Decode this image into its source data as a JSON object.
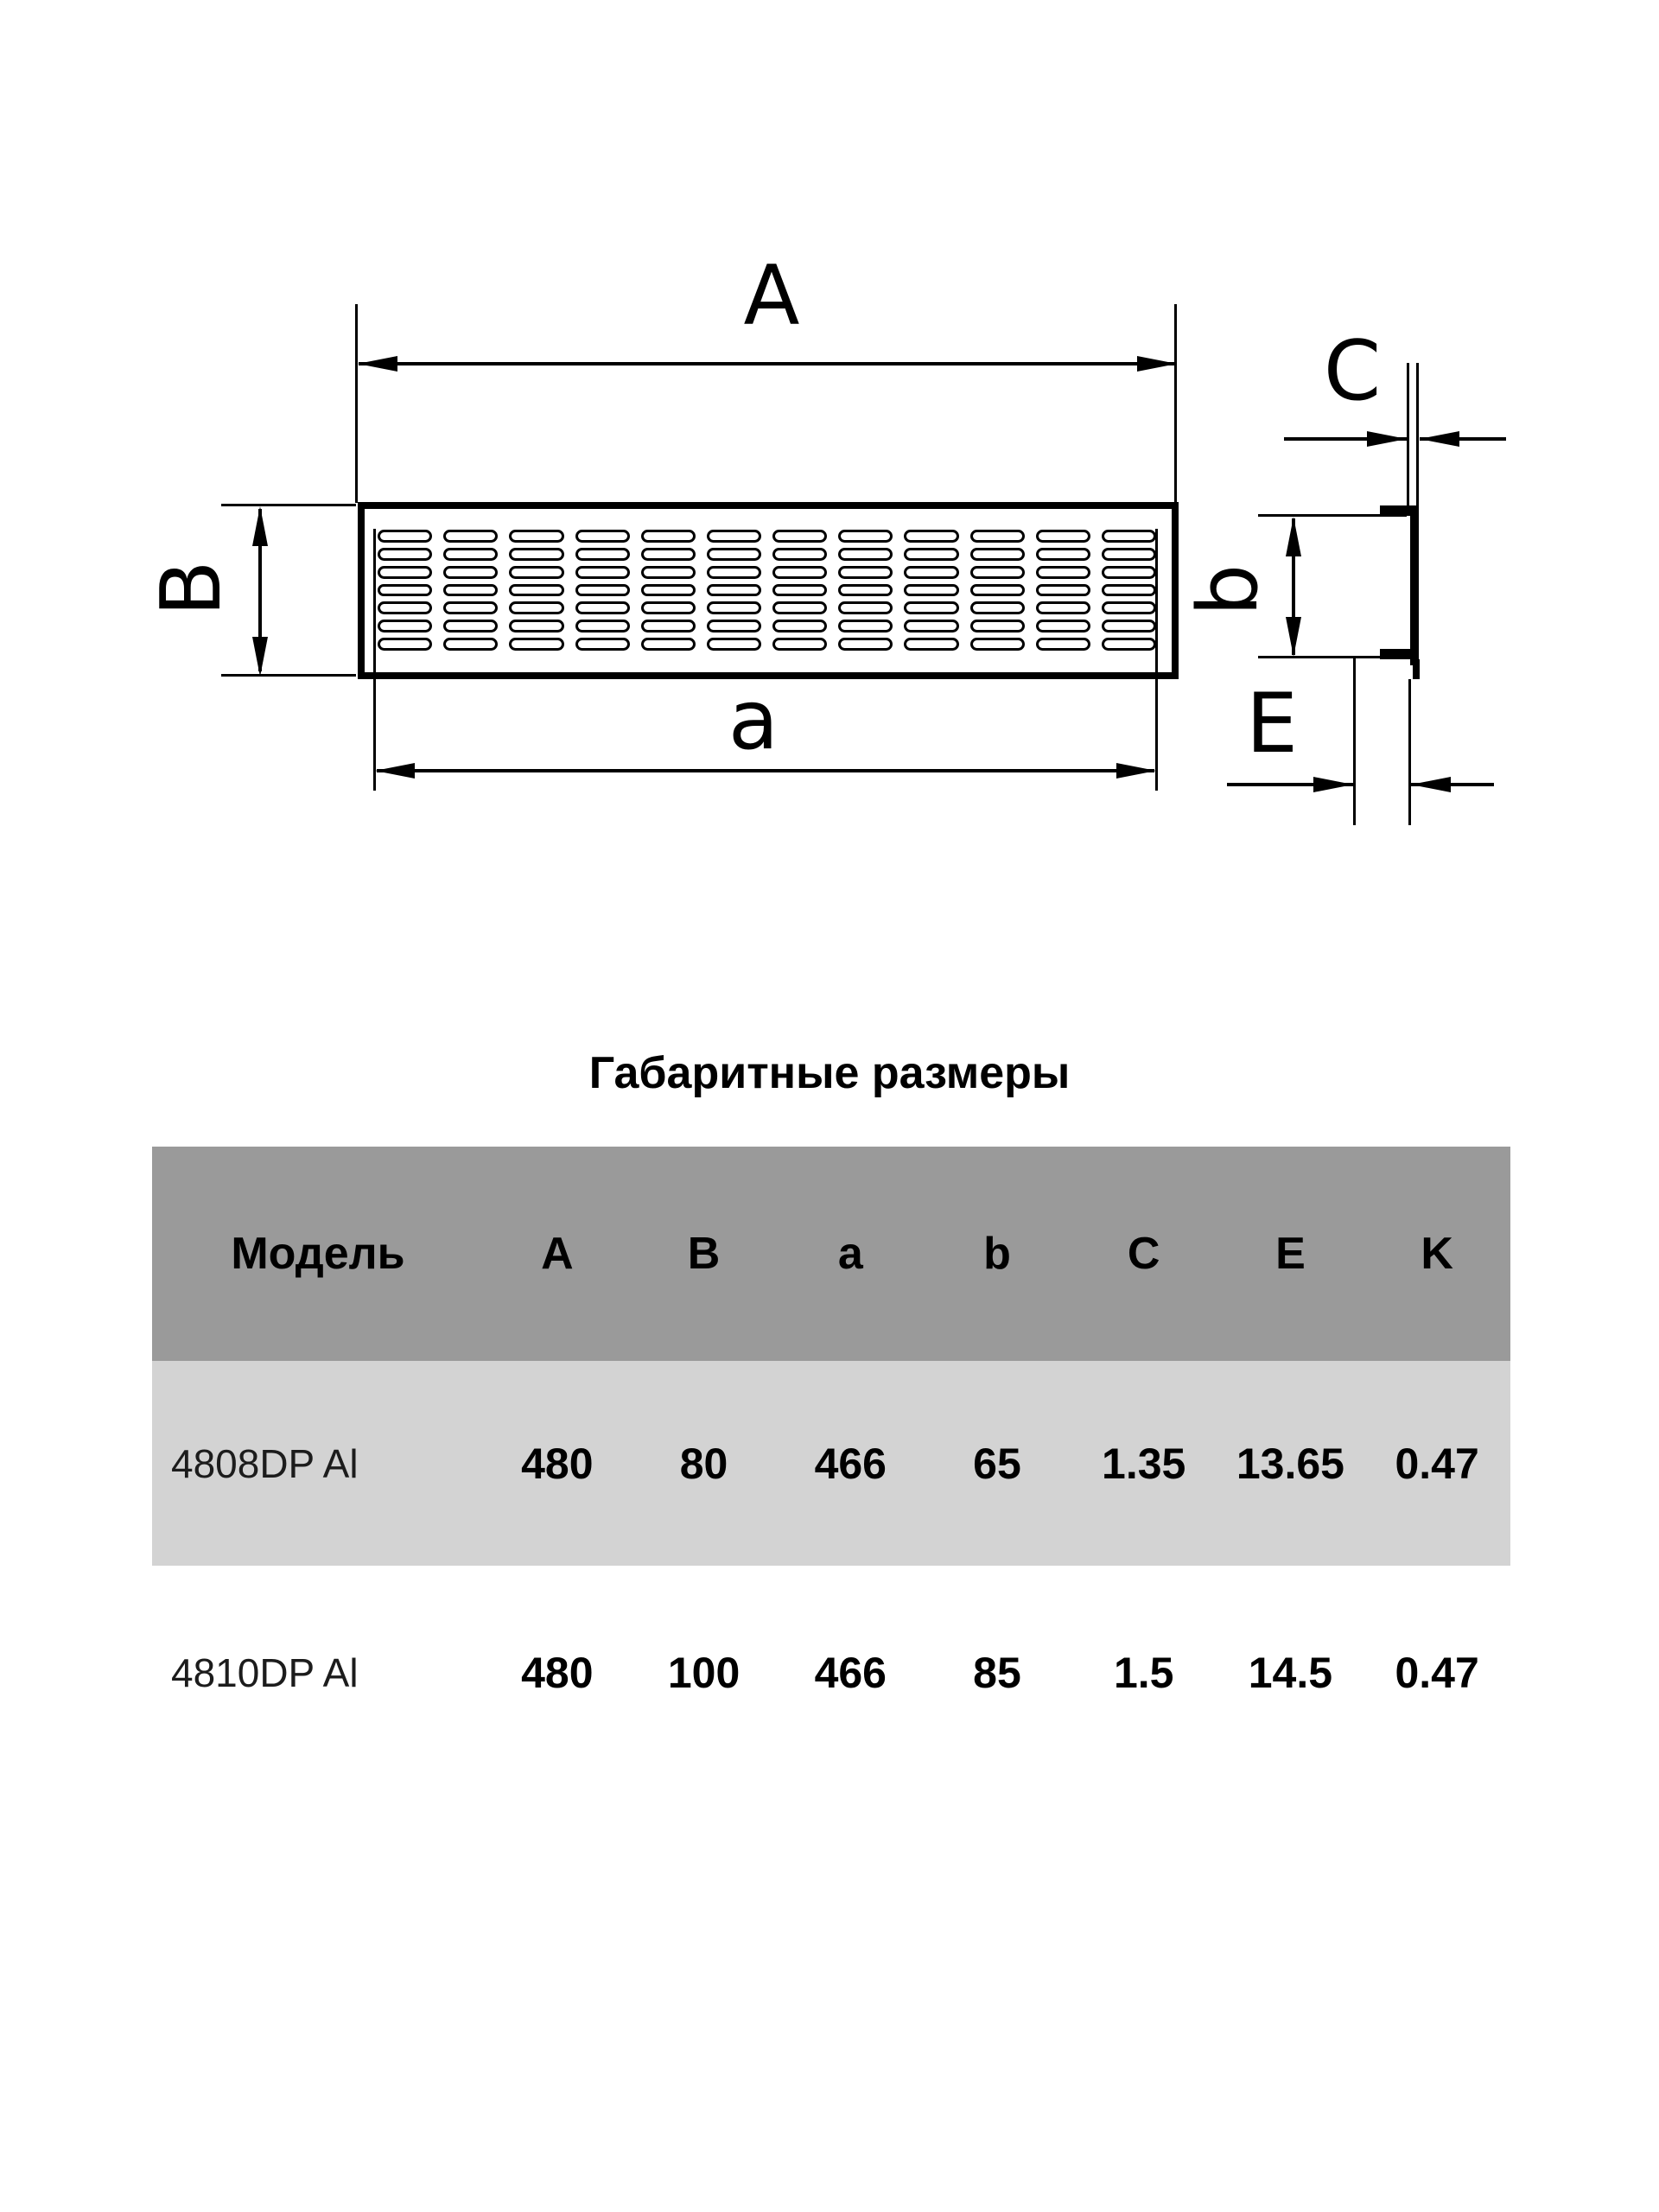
{
  "page": {
    "background": "#ffffff",
    "line_color": "#000000"
  },
  "drawing": {
    "front_view": {
      "label_A": "A",
      "label_B": "B",
      "label_a": "a",
      "slot_rows": 7,
      "slot_cols": 12
    },
    "side_view": {
      "label_C": "C",
      "label_b": "b",
      "label_E": "E"
    }
  },
  "table": {
    "title": "Габаритные размеры",
    "columns": [
      "Модель",
      "A",
      "B",
      "a",
      "b",
      "C",
      "E",
      "K"
    ],
    "rows": [
      {
        "model": "4808DP Al",
        "values": [
          "480",
          "80",
          "466",
          "65",
          "1.35",
          "13.65",
          "0.47"
        ]
      },
      {
        "model": "4810DP Al",
        "values": [
          "480",
          "100",
          "466",
          "85",
          "1.5",
          "14.5",
          "0.47"
        ]
      }
    ],
    "colors": {
      "header_bg": "#9a9a9a",
      "row_alt_bg": "#d3d3d3",
      "row_bg": "#ffffff",
      "text": "#000000"
    }
  }
}
